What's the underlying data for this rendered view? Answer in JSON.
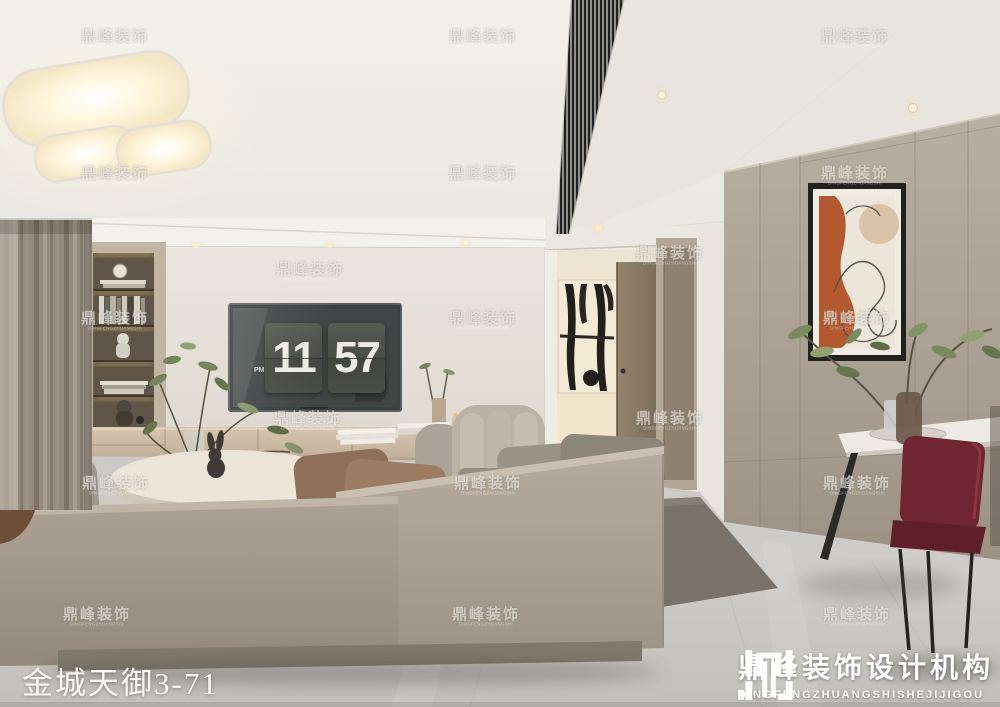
{
  "watermark": {
    "cn": "鼎峰装饰",
    "en": "DINGFENGZHUANGSHI"
  },
  "caption": {
    "text": "金城天御3-71"
  },
  "clock": {
    "hour": "11",
    "minute": "57",
    "meridiem": "PM"
  },
  "logo": {
    "cn": "鼎峰装饰设计机构",
    "en": "DINGFENGZHUANGSHISHEJIJIGOU"
  },
  "palette": {
    "ceiling": "#f0eee9",
    "tv_wall": "#e7e3db",
    "curtain": "#948b7f",
    "sofa": "#a49b8e",
    "sofa_top": "#c6bdaf",
    "pillow_brown": "#8e6f57",
    "rug": "#79726a",
    "floor": "#c9c7c2",
    "hall_glow": "#f3e6cd",
    "panel_wall": "#aea699",
    "console": "#cdbda7",
    "tv_screen": "#3d403f",
    "clock_card": "#4b4e47",
    "art_terracotta": "#b2592f",
    "art_beige": "#d9c2a6",
    "chair_red": "#6f2532",
    "plant_green": "#76845e",
    "door_brown": "#8b7c68",
    "watermark_white": "#ffffff"
  }
}
